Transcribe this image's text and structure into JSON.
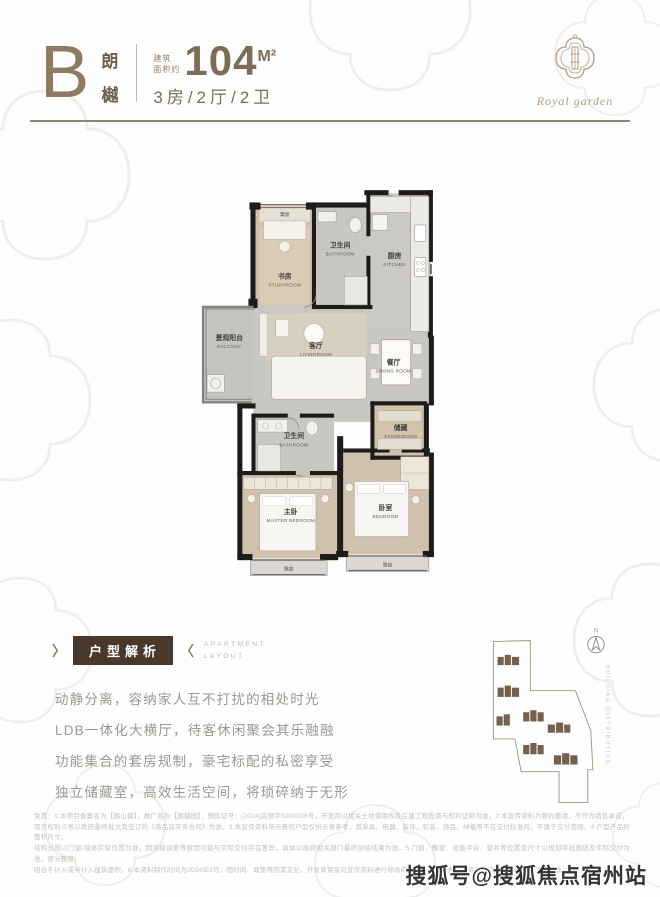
{
  "header": {
    "type_letter": "B",
    "type_name": [
      "朗",
      "樾"
    ],
    "area_prefix": [
      "建筑",
      "面积约"
    ],
    "area_value": "104",
    "area_unit": "M²",
    "layout": "3房/2厅/2卫"
  },
  "logo": {
    "brand": "Royal garden"
  },
  "floorplan": {
    "rooms": {
      "study": {
        "zh": "书房",
        "en": "STUDYROOM"
      },
      "bath_top": {
        "zh": "卫生间",
        "en": "BATHROOM"
      },
      "kitchen": {
        "zh": "厨房",
        "en": "KITCHEN"
      },
      "balcony": {
        "zh": "景观阳台",
        "en": "BALCONY"
      },
      "living": {
        "zh": "客厅",
        "en": "LIVINGROOM"
      },
      "dining": {
        "zh": "餐厅",
        "en": "DINING ROOM"
      },
      "storeroom": {
        "zh": "储藏",
        "en": "STOREROOM"
      },
      "bath_mid": {
        "zh": "卫生间",
        "en": "BATHROOM"
      },
      "master": {
        "zh": "主卧",
        "en": "MASTER BEDROOM"
      },
      "bedroom": {
        "zh": "卧室",
        "en": "BEDROOM"
      }
    },
    "bay_window_label": "飘窗"
  },
  "section": {
    "title": "户型解析",
    "subtitle": [
      "APARTMENT",
      "LAYOUT"
    ],
    "angle_left": "〉",
    "angle_right": "〈"
  },
  "analysis": {
    "lines": [
      "动静分离，容纳家人互不打扰的相处时光",
      "LDB一体化大横厅，待客休闲聚会其乐融融",
      "功能集合的套房规制，豪宅标配的私密享受",
      "独立储藏室，高效生活空间，将琐碎纳于无形"
    ]
  },
  "siteplan": {
    "compass_label": "N",
    "side_label": "BUILDING DISTRIBUTION"
  },
  "disclaimer": {
    "lines": [
      "免责：1.本项目备案名为【朗山樾】，推广名为【朗樾园】，预售证号：(2024)房预字5000036号，开发商以相关土地使用权及在建工程投资与权利证照为准。2.本宣传资料为要约邀请，不作为销售承诺，",
      "双方权利义务以政府最终批文及签订的《商品房买卖合同》为准。3.本宣传资料所示意的户型仅供示意参考，其家具、电器、装饰、软装、饰品、绿植等不在交付标准内，不属于交付范围。4.户型产品的面积尺寸、",
      "结构分隔以门窗/墙体实际位置为准，因测绘误差等原因可能与实际交付存在差异，具体以政府相关部门最终测绘结果为准。5.门窗、飘窗、设备平台、管井等位置及尺寸以规划审批图纸及实际交付为准，部分飘窗、",
      "阳台不计入或半计入建筑面积。6.本资料制作时间为2024年9月，因时间、政策等因素变化，开发商保留对宣传资料进行修改的权利，敬请留意最新资料，欢迎莅临售楼处了解详情。"
    ]
  },
  "watermark": {
    "text": "搜狐号@搜狐焦点宿州站"
  }
}
